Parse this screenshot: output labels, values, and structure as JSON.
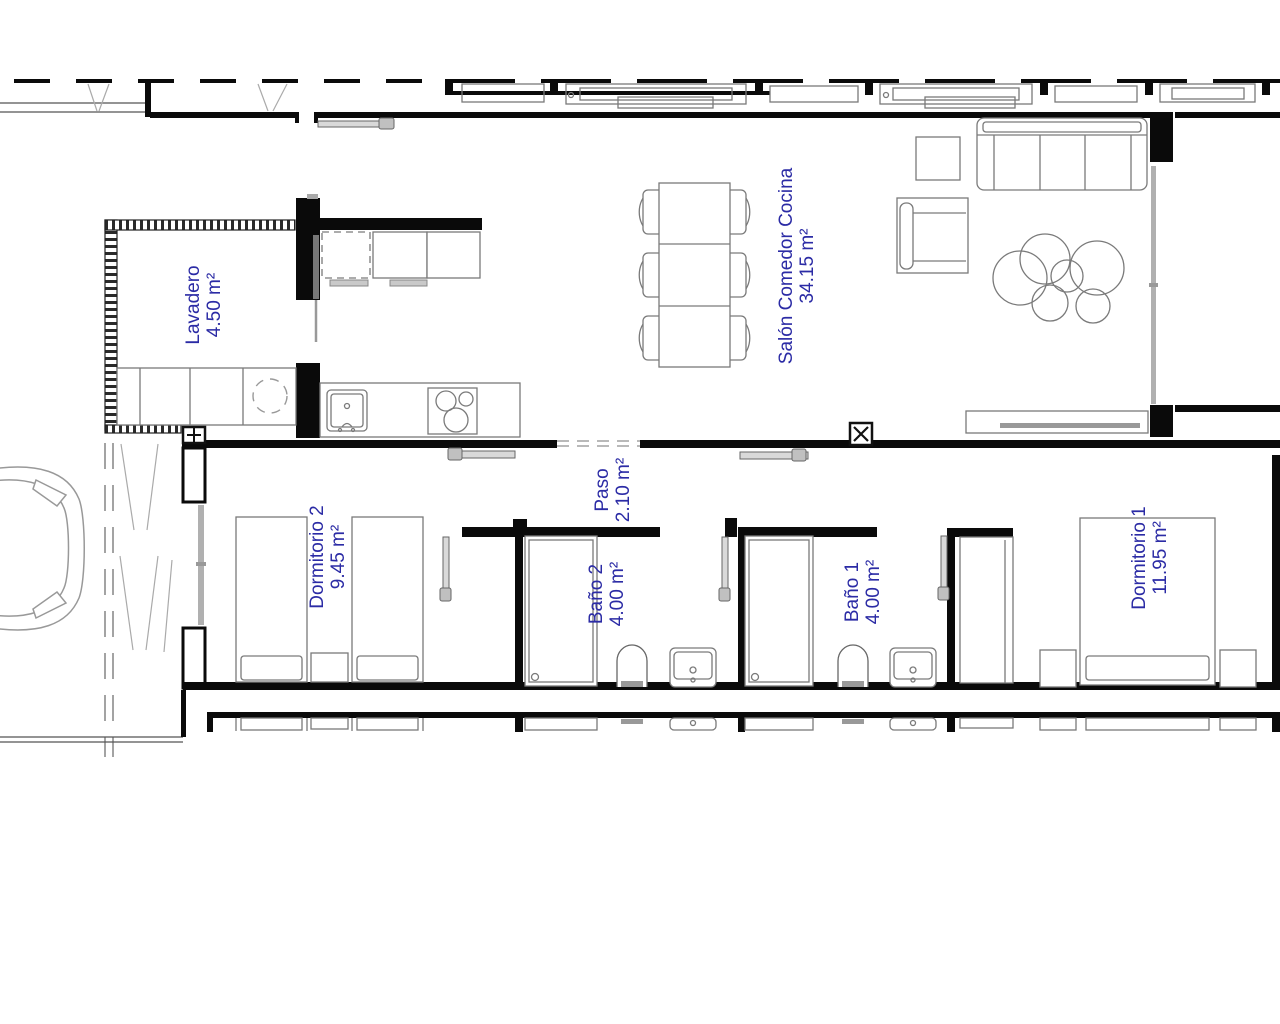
{
  "plan": {
    "type": "floor-plan",
    "colors": {
      "label": "#2B2BA5",
      "wall": "#0A0A0A",
      "furniture": "#7A7A7A",
      "glazing": "#B0B0B0",
      "door_leaf": "#D9D9D9"
    },
    "rooms": [
      {
        "id": "lavadero",
        "name": "Lavadero",
        "area": "4.50 m²"
      },
      {
        "id": "salon",
        "name": "Salón Comedor Cocina",
        "area": "34.15 m²"
      },
      {
        "id": "paso",
        "name": "Paso",
        "area": "2.10 m²"
      },
      {
        "id": "dormitorio2",
        "name": "Dormitorio 2",
        "area": "9.45 m²"
      },
      {
        "id": "bano2",
        "name": "Baño 2",
        "area": "4.00 m²"
      },
      {
        "id": "bano1",
        "name": "Baño 1",
        "area": "4.00 m²"
      },
      {
        "id": "dormitorio1",
        "name": "Dormitorio 1",
        "area": "11.95 m²"
      }
    ],
    "symbols": [
      {
        "id": "x-symbol",
        "glyph": "X"
      },
      {
        "id": "plus-symbol",
        "glyph": "+"
      }
    ]
  }
}
